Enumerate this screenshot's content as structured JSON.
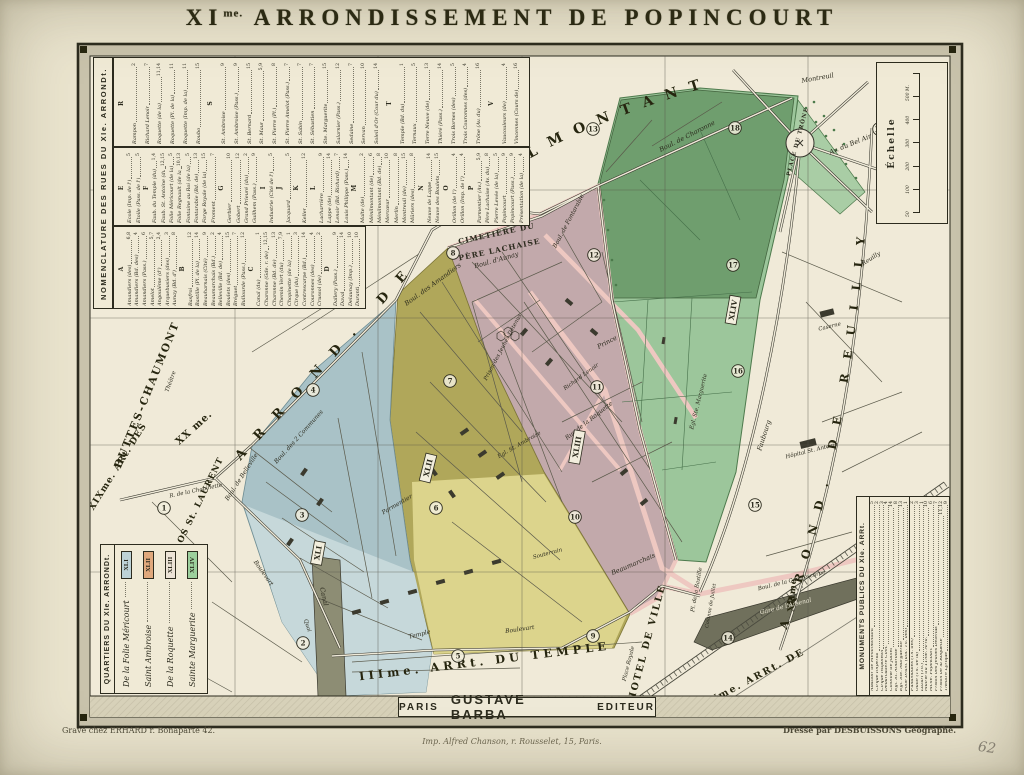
{
  "title": {
    "prefix": "XI",
    "sup": "me.",
    "rest": " ARRONDISSEMENT DE POPINCOURT"
  },
  "nomenclature": {
    "title": "NOMENCLATURE DES RUES DU XIe. ARRONDt.",
    "bands": [
      [
        "R",
        "S",
        "T",
        "V"
      ],
      [
        "E",
        "F",
        "G",
        "I",
        "J",
        "K",
        "L",
        "M",
        "N",
        "O",
        "P"
      ],
      [
        "A",
        "B",
        "C",
        "D"
      ]
    ],
    "sections": {
      "A": [
        [
          "Amandiers (des)",
          "6,8"
        ],
        [
          "Amandiers (Bd. des)",
          "4"
        ],
        [
          "Amandiers (Pass.)",
          "6"
        ],
        [
          "Amelot",
          "5,7"
        ],
        [
          "Angoulême (d')",
          "2,4"
        ],
        [
          "Arquebusiers (des)",
          "3"
        ],
        [
          "Aunay (Bd. d')",
          "8"
        ]
      ],
      "B": [
        [
          "Basfroi",
          "12"
        ],
        [
          "Bastille (Pl. de la)",
          "14"
        ],
        [
          "Beauharnais (Cité)",
          "9"
        ],
        [
          "Beaumarchais (Bd.)",
          "2"
        ],
        [
          "Belleville (Bd. de)",
          "4"
        ],
        [
          "Boulets (des)",
          "15"
        ],
        [
          "Bréguet",
          "7"
        ],
        [
          "Bullourde (Pass.)",
          "12"
        ]
      ],
      "C": [
        [
          "Canal (du)",
          "1"
        ],
        [
          "Charonne (Gde. r. de)",
          "12,15"
        ],
        [
          "Charonne (Bd. de)",
          "13"
        ],
        [
          "Chemin Vert (du)",
          "7,9"
        ],
        [
          "Chopinette (de la)",
          "1"
        ],
        [
          "Cirque (du)",
          "3"
        ],
        [
          "Contrescarpe (Bd.)",
          "14"
        ],
        [
          "Couronnes (des)",
          "4"
        ],
        [
          "Crussol (de)",
          "2"
        ]
      ],
      "D": [
        [
          "Dallery (Pass.)",
          "9"
        ],
        [
          "Daval",
          "14"
        ],
        [
          "Delaunay (Imp.)",
          "10"
        ],
        [
          "Duranti",
          "10"
        ]
      ],
      "E": [
        [
          "École (Imp. de l')",
          "5"
        ],
        [
          "Étoile (Pass. de l')",
          "5"
        ]
      ],
      "F": [
        [
          "Faub. du Temple (du)",
          "1,4"
        ],
        [
          "Faub. St. Antoine (du)",
          "12,15"
        ],
        [
          "Folie Méricourt (de la)",
          "5"
        ],
        [
          "Folie Regnault (de la)",
          "10,13"
        ],
        [
          "Fontaine au Roi (de la)",
          "5"
        ],
        [
          "Fontarabie (Bd. de)",
          "13"
        ],
        [
          "Forge Royale (de la)",
          "15"
        ],
        [
          "Froment",
          "7"
        ]
      ],
      "G": [
        [
          "Gerbier",
          "10"
        ],
        [
          "Gobert",
          "12"
        ],
        [
          "Grand Prieuré (du)",
          "2"
        ],
        [
          "Guilhem (Pass.)",
          "9"
        ]
      ],
      "I": [
        [
          "Industrie (Cité de l')",
          "5"
        ]
      ],
      "J": [
        [
          "Jacquard",
          "5"
        ]
      ],
      "K": [
        [
          "Keller",
          "12"
        ]
      ],
      "L": [
        [
          "Lacharrière",
          "9"
        ],
        [
          "Lappe (de)",
          "14"
        ],
        [
          "Lenoir (Bd. Richard)",
          "7"
        ],
        [
          "Louis Philippe (Pass.)",
          "14"
        ]
      ],
      "M": [
        [
          "Malte (de)",
          "2"
        ],
        [
          "Ménilmontant (de)",
          "6"
        ],
        [
          "Ménilmontant (Bd. de)",
          "8"
        ],
        [
          "Mercœur",
          "10"
        ],
        [
          "Merlin",
          "8"
        ],
        [
          "Montreuil (de)",
          "15"
        ],
        [
          "Mûriers (des)",
          "8"
        ]
      ],
      "N": [
        [
          "Neuve de Lappe",
          "14"
        ],
        [
          "Neuve des Boulets",
          "15"
        ]
      ],
      "O": [
        [
          "Orillon (de l')",
          "4"
        ],
        [
          "Orillon (Imp. de l')",
          "4"
        ]
      ],
      "P": [
        [
          "Parmentier (Av.)",
          "5,9"
        ],
        [
          "Père Lachaise (Av. du)",
          "8"
        ],
        [
          "Pierre Levée (de la)",
          "5"
        ],
        [
          "Popincourt",
          "9"
        ],
        [
          "Popincourt (Pass.)",
          "9"
        ],
        [
          "Présentation (de la)",
          "4"
        ]
      ],
      "R": [
        [
          "Rampon",
          "2"
        ],
        [
          "Richard Lenoir",
          "7"
        ],
        [
          "Roquette (de la)",
          "11,14"
        ],
        [
          "Roquette (Pl. de la)",
          "11"
        ],
        [
          "Roquette (Imp. de la)",
          "11"
        ],
        [
          "Roubo",
          "15"
        ]
      ],
      "S": [
        [
          "St. Ambroise",
          "9"
        ],
        [
          "St. Ambroise (Pass.)",
          "9"
        ],
        [
          "St. Bernard",
          "15"
        ],
        [
          "St. Maur",
          "5,9"
        ],
        [
          "St. Pierre (Pl.)",
          "8"
        ],
        [
          "St. Pierre Amelot (Pass.)",
          "7"
        ],
        [
          "St. Sabin",
          "7"
        ],
        [
          "St. Sébastien",
          "7"
        ],
        [
          "Ste. Marguerite",
          "15"
        ],
        [
          "Salarnier (Pass.)",
          "12"
        ],
        [
          "Sedaine",
          "7"
        ],
        [
          "Servan",
          "10"
        ],
        [
          "Soleil d'Or (Cour du)",
          "14"
        ]
      ],
      "T": [
        [
          "Temple (Bd. du)",
          "1"
        ],
        [
          "Ternaux",
          "5"
        ],
        [
          "Terre Neuve (de)",
          "13"
        ],
        [
          "Thiéré (Pass.)",
          "14"
        ],
        [
          "Trois Bornes (des)",
          "5"
        ],
        [
          "Trois Couronnes (des)",
          "4"
        ],
        [
          "Trône (Av. du)",
          "16"
        ]
      ],
      "V": [
        [
          "Vaucouleurs (de)",
          "4"
        ],
        [
          "Vincennes (Cours de)",
          "16"
        ]
      ]
    }
  },
  "quartiers": {
    "title": "QUARTIERS DU XIe. ARRONDt.",
    "entries": [
      {
        "name": "De la Folie Méricourt",
        "roman": "XLI",
        "color": "#bdd2d6"
      },
      {
        "name": "Saint Ambroise",
        "roman": "XLII",
        "color": "#e0a87c"
      },
      {
        "name": "De la Roquette",
        "roman": "XLIII",
        "color": "#ece3d6"
      },
      {
        "name": "Sainte Marguerite",
        "roman": "XLIV",
        "color": "#9ccf9c"
      }
    ]
  },
  "monuments": {
    "title": "MONUMENTS PUBLICS DU XIe. ARRt.",
    "columns": [
      [
        [
          "Abattoir de Ménilmontant",
          "5"
        ],
        [
          "Cirque Impérial",
          "2"
        ],
        [
          "Cirque Napoléon",
          "3"
        ],
        [
          "Débarcadère Com.",
          "4"
        ],
        [
          "Colonne de Juillet",
          "14"
        ],
        [
          "Égl. St. Ambroise",
          "8"
        ],
        [
          "Égl. Ste. Marguerite",
          "13"
        ],
        [
          "Folie Dram. (anc. Th. des)",
          "1"
        ]
      ],
      [
        [
          "Funambules (Th. des)",
          "2"
        ],
        [
          "Gaîté (Th. de la)",
          "3"
        ],
        [
          "Lazari (Th.)",
          "1"
        ],
        [
          "Mairie du 11me. Arrd.",
          "10"
        ],
        [
          "Mché. Popincourt",
          "6"
        ],
        [
          "Prison des Jeunes Détenus",
          "7"
        ],
        [
          "Prison de la Roquette",
          "11,12"
        ],
        [
          "Théâtre Lyrique",
          "9"
        ]
      ]
    ]
  },
  "scale": {
    "label": "Échelle",
    "ticks": [
      "50",
      "100",
      "200",
      "300",
      "400",
      "500 M."
    ]
  },
  "imprint": {
    "city": "PARIS",
    "publisher": "GUSTAVE BARBA",
    "role": "EDITEUR",
    "printer": "Imp. Alfred Chanson, r. Rousselet, 15, Paris.",
    "engraver": "Gravé chez ERHARD r. Bonaparte 42.",
    "author": "Dressé par DESBUISSONS Géographe.",
    "hand_note": "62"
  },
  "map": {
    "curved": {
      "arrond": "ARROND. DE",
      "menilmontant": "MÉNILMONTANT",
      "reuilly": "ARROND. DE REUILLY"
    },
    "labels": [
      {
        "t": "XIXme. ARt. DES",
        "x": 120,
        "y": 468,
        "r": -58,
        "s": 9,
        "c": "big",
        "ls": 1
      },
      {
        "t": "BUTTES-CHAUMONT",
        "x": 150,
        "y": 396,
        "r": -68,
        "s": 10.5,
        "c": "big",
        "ls": 2
      },
      {
        "t": "XX me.",
        "x": 196,
        "y": 430,
        "r": -42,
        "s": 10,
        "c": "big",
        "ls": 1
      },
      {
        "t": "Xme. ARt. DE L'ENCLOS St. LAURENT",
        "x": 176,
        "y": 556,
        "r": -64,
        "s": 8.5,
        "c": "big",
        "ls": 1
      },
      {
        "t": "IIIme. ARRt. DU TEMPLE",
        "x": 485,
        "y": 665,
        "r": -7,
        "s": 11.5,
        "c": "big",
        "ls": 4
      },
      {
        "t": "IVme. ARRt. DE",
        "x": 756,
        "y": 680,
        "r": -28,
        "s": 9.5,
        "c": "big",
        "ls": 2
      },
      {
        "t": "L'HOTEL DE VILLE",
        "x": 648,
        "y": 650,
        "r": -75,
        "s": 9.5,
        "c": "big",
        "ls": 2
      },
      {
        "t": "XIIme.",
        "x": 795,
        "y": 593,
        "r": -85,
        "s": 8.5,
        "c": "big",
        "ls": 1
      },
      {
        "t": "CIMETIÈRE DU",
        "x": 497,
        "y": 236,
        "r": -12,
        "s": 7.5,
        "c": "cap"
      },
      {
        "t": "PÈRE LACHAISE",
        "x": 500,
        "y": 252,
        "r": -12,
        "s": 7.5,
        "c": "cap"
      },
      {
        "t": "PLACE DU TRÔNE",
        "x": 799,
        "y": 142,
        "r": -75,
        "s": 5.5,
        "c": "cap"
      },
      {
        "t": "Av. du Bel Air",
        "x": 851,
        "y": 146,
        "r": -22,
        "s": 6.5,
        "c": "it"
      },
      {
        "t": "Montreuil",
        "x": 818,
        "y": 80,
        "r": -10,
        "s": 6.5,
        "c": "it"
      },
      {
        "t": "Boul. de Charonne",
        "x": 688,
        "y": 138,
        "r": -27,
        "s": 6.5,
        "c": "it"
      },
      {
        "t": "Boul. de Fontarabie",
        "x": 570,
        "y": 222,
        "r": -62,
        "s": 6,
        "c": "it"
      },
      {
        "t": "Boul. d'Aunay",
        "x": 497,
        "y": 262,
        "r": -16,
        "s": 6.5,
        "c": "it"
      },
      {
        "t": "Boul. des Amandiers",
        "x": 434,
        "y": 286,
        "r": -36,
        "s": 6.5,
        "c": "it"
      },
      {
        "t": "Boul. des 2 Communes",
        "x": 300,
        "y": 438,
        "r": -48,
        "s": 6,
        "c": "it"
      },
      {
        "t": "Boul. de Belleville",
        "x": 243,
        "y": 478,
        "r": -57,
        "s": 6,
        "c": "it"
      },
      {
        "t": "R. de la Chopinette",
        "x": 196,
        "y": 492,
        "r": -12,
        "s": 5.5,
        "c": "it"
      },
      {
        "t": "Rue de la Roquette",
        "x": 590,
        "y": 422,
        "r": -38,
        "s": 6,
        "c": "it"
      },
      {
        "t": "Prince",
        "x": 608,
        "y": 344,
        "r": -28,
        "s": 6.5,
        "c": "it"
      },
      {
        "t": "Richard Lenoir",
        "x": 582,
        "y": 378,
        "r": -36,
        "s": 5.5,
        "c": "it"
      },
      {
        "t": "Parmentier",
        "x": 398,
        "y": 506,
        "r": -30,
        "s": 6,
        "c": "it"
      },
      {
        "t": "Temple",
        "x": 420,
        "y": 636,
        "r": -14,
        "s": 6,
        "c": "it"
      },
      {
        "t": "Beaumarchais",
        "x": 634,
        "y": 566,
        "r": -23,
        "s": 6.5,
        "c": "it"
      },
      {
        "t": "Boulevart",
        "x": 520,
        "y": 631,
        "r": -8,
        "s": 6,
        "c": "it"
      },
      {
        "t": "Boulevart",
        "x": 262,
        "y": 574,
        "r": 55,
        "s": 6,
        "c": "it"
      },
      {
        "t": "Canal",
        "x": 322,
        "y": 597,
        "r": 78,
        "s": 6.5,
        "c": "it"
      },
      {
        "t": "Quai",
        "x": 306,
        "y": 626,
        "r": 72,
        "s": 5.5,
        "c": "it"
      },
      {
        "t": "Souterrain",
        "x": 548,
        "y": 555,
        "r": -15,
        "s": 5.5,
        "c": "it"
      },
      {
        "t": "Faubourg",
        "x": 766,
        "y": 436,
        "r": -72,
        "s": 6.5,
        "c": "it"
      },
      {
        "t": "Reuilly",
        "x": 872,
        "y": 260,
        "r": -33,
        "s": 6,
        "c": "it"
      },
      {
        "t": "Caserne",
        "x": 830,
        "y": 328,
        "r": -14,
        "s": 5.5,
        "c": "it"
      },
      {
        "t": "Hôpital St. Antoine",
        "x": 812,
        "y": 452,
        "r": -14,
        "s": 5.5,
        "c": "it"
      },
      {
        "t": "Gare de l'Arsenal",
        "x": 786,
        "y": 608,
        "r": -14,
        "s": 6,
        "c": "light"
      },
      {
        "t": "Boul. de la Contrescarpe",
        "x": 792,
        "y": 582,
        "r": -14,
        "s": 5.5,
        "c": "it"
      },
      {
        "t": "Pl. de la Bastille",
        "x": 698,
        "y": 590,
        "r": -80,
        "s": 5.5,
        "c": "it"
      },
      {
        "t": "Colonne de Juillet",
        "x": 712,
        "y": 606,
        "r": -80,
        "s": 5,
        "c": "it"
      },
      {
        "t": "Prison des Jeunes Détenus",
        "x": 504,
        "y": 348,
        "r": -62,
        "s": 5.5,
        "c": "it"
      },
      {
        "t": "Égl. Ste. Marguerite",
        "x": 700,
        "y": 402,
        "r": -76,
        "s": 5.5,
        "c": "it"
      },
      {
        "t": "Place Royale",
        "x": 630,
        "y": 664,
        "r": -76,
        "s": 5.5,
        "c": "it"
      },
      {
        "t": "Égl. St. Ambroise",
        "x": 520,
        "y": 446,
        "r": -30,
        "s": 5.5,
        "c": "it"
      },
      {
        "t": "Théâtre",
        "x": 172,
        "y": 382,
        "r": -70,
        "s": 5.5,
        "c": "it"
      }
    ],
    "circles": [
      {
        "n": "1",
        "x": 164,
        "y": 508
      },
      {
        "n": "2",
        "x": 303,
        "y": 643
      },
      {
        "n": "3",
        "x": 302,
        "y": 515
      },
      {
        "n": "4",
        "x": 313,
        "y": 390
      },
      {
        "n": "5",
        "x": 458,
        "y": 656
      },
      {
        "n": "6",
        "x": 436,
        "y": 508
      },
      {
        "n": "7",
        "x": 450,
        "y": 381
      },
      {
        "n": "8",
        "x": 453,
        "y": 253
      },
      {
        "n": "9",
        "x": 593,
        "y": 636
      },
      {
        "n": "10",
        "x": 575,
        "y": 517
      },
      {
        "n": "11",
        "x": 597,
        "y": 387
      },
      {
        "n": "12",
        "x": 594,
        "y": 255
      },
      {
        "n": "13",
        "x": 593,
        "y": 129
      },
      {
        "n": "14",
        "x": 728,
        "y": 638
      },
      {
        "n": "15",
        "x": 755,
        "y": 505
      },
      {
        "n": "16",
        "x": 738,
        "y": 371
      },
      {
        "n": "17",
        "x": 733,
        "y": 265
      },
      {
        "n": "18",
        "x": 735,
        "y": 128
      },
      {
        "n": "19",
        "x": 879,
        "y": 129
      }
    ],
    "quartier_boxes": [
      {
        "t": "XLI",
        "x": 318,
        "y": 553,
        "r": -80
      },
      {
        "t": "XLII",
        "x": 428,
        "y": 468,
        "r": -76
      },
      {
        "t": "XLIII",
        "x": 577,
        "y": 447,
        "r": -80
      },
      {
        "t": "XLIV",
        "x": 733,
        "y": 310,
        "r": -80
      }
    ]
  }
}
